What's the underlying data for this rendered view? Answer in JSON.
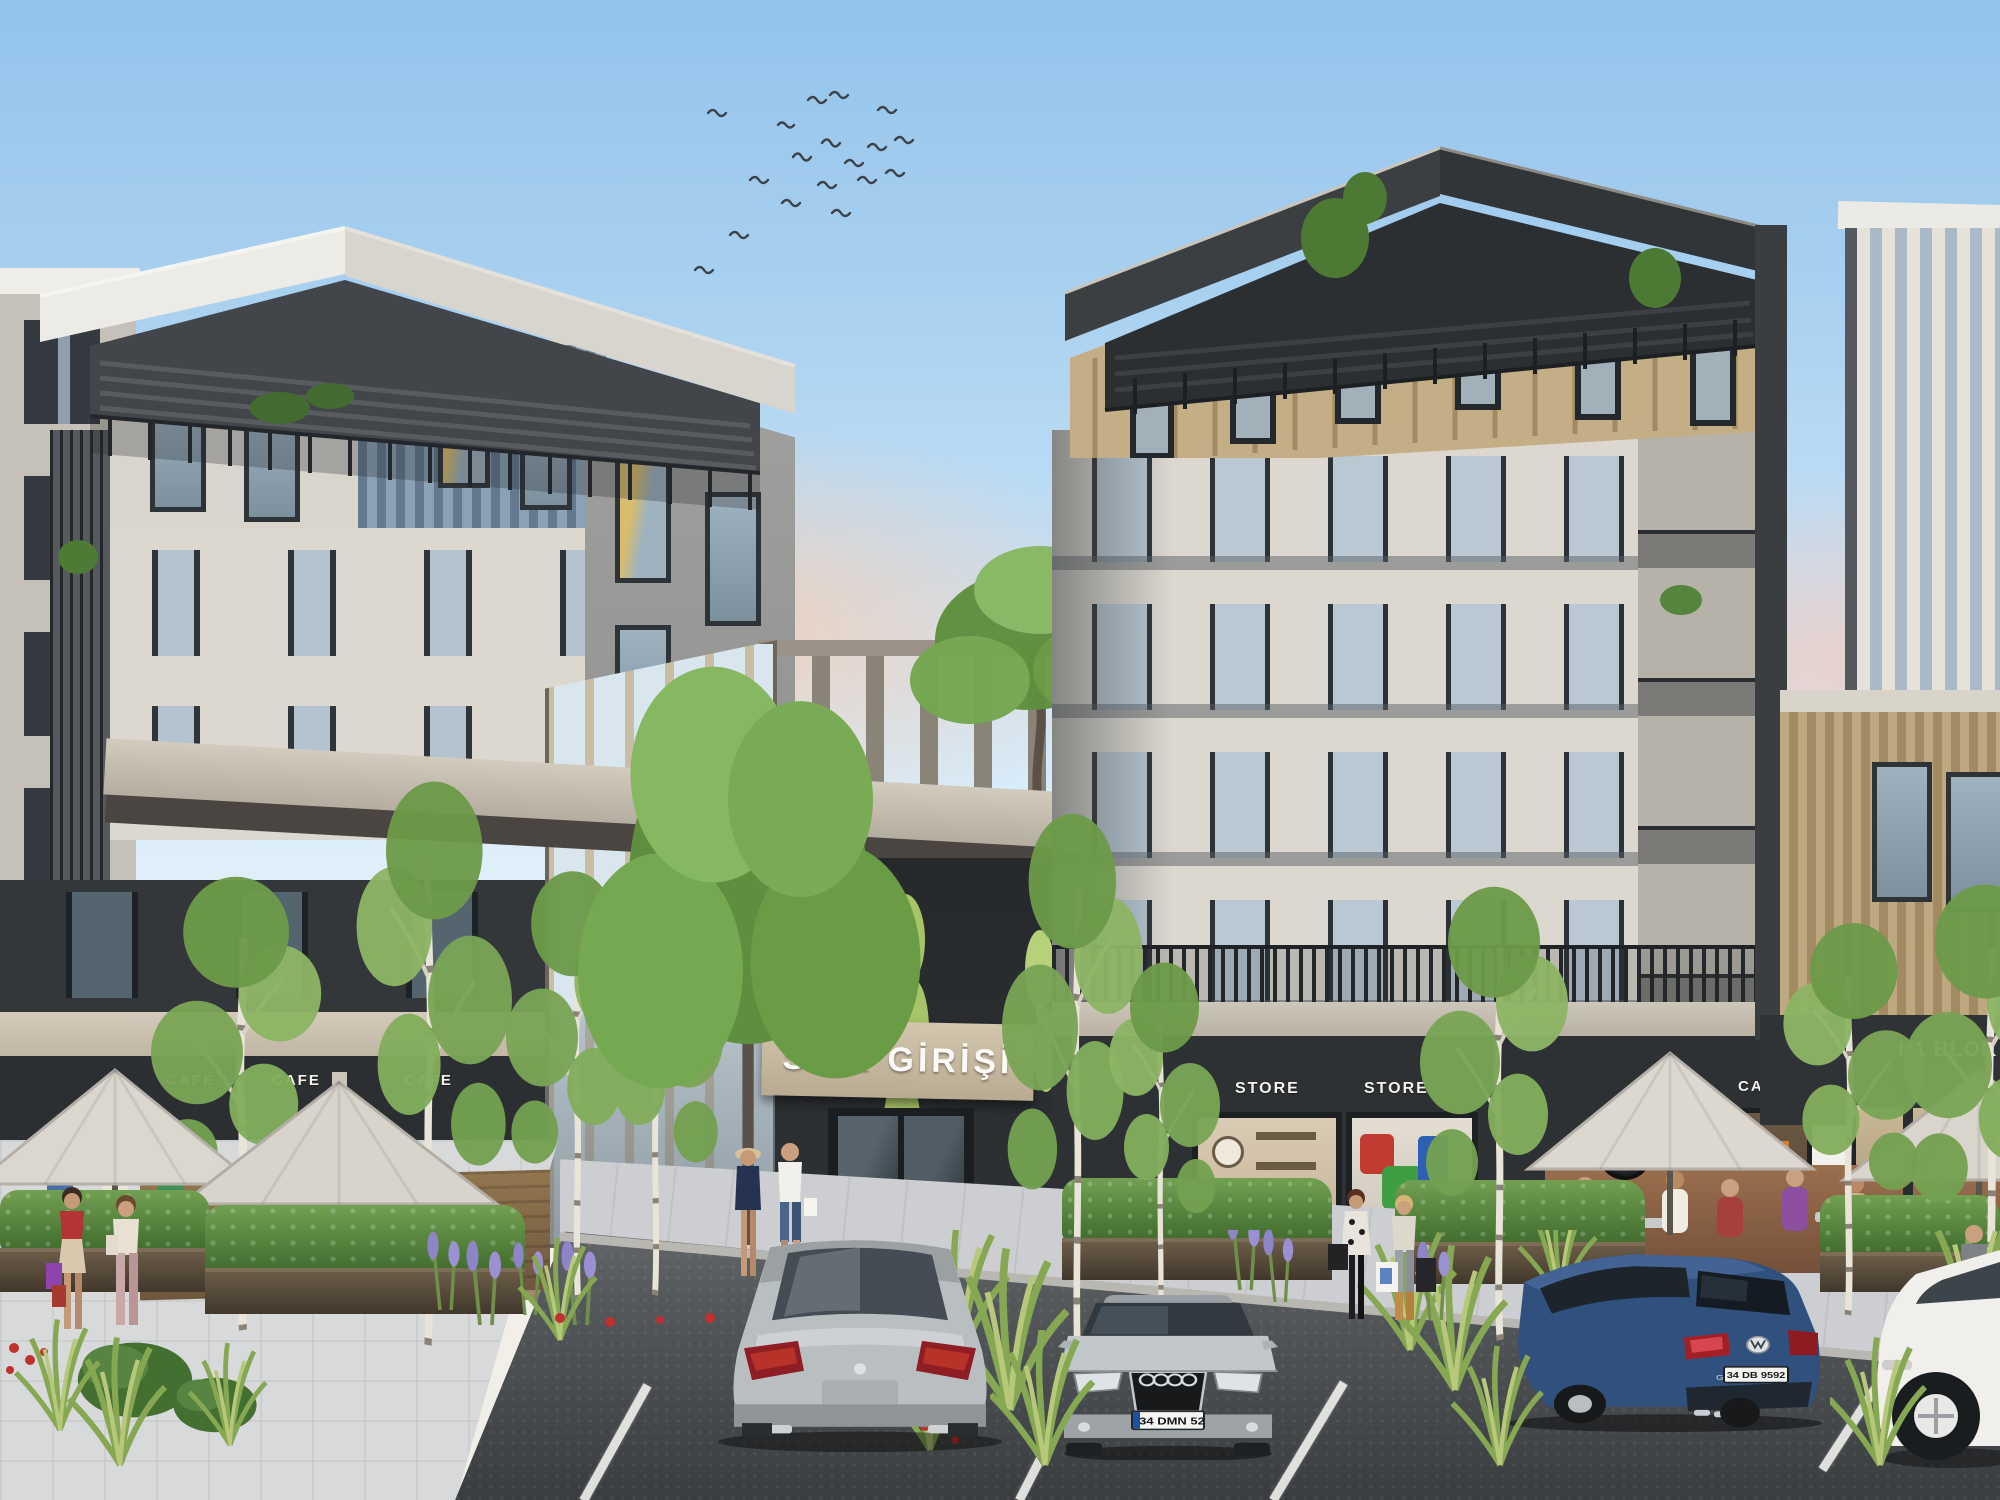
{
  "scene": {
    "description": "Daytime architectural rendering of a modern residential complex: two five-storey blocks with white facades, charcoal bases, wood and blue-grey slat accents, a central SITE GIRISI entrance, ground-floor cafes and stores with outdoor umbrella seating, landscaped plaza with birch trees, pedestrians with shopping bags, and a foreground parking lot with cars; a flock of birds in the blue sky"
  },
  "signs": {
    "entrance": "SİTE GİRİŞİ",
    "left_cafes": [
      "CAFE",
      "CAFE",
      "CAFE"
    ],
    "stores": [
      "STORE",
      "STORE"
    ],
    "right_cafes": [
      "CAFE",
      "CAFE"
    ],
    "block": "H1 BLOK"
  },
  "vehicles": {
    "audi": {
      "plate": "34 DMN 52"
    },
    "golf": {
      "plate": "34 DB 9592",
      "badge": "GOLF"
    }
  },
  "palette": {
    "sky_top": "#93c3eb",
    "horizon_glow": "#f6cdb2",
    "facade_light": "#dcd8d0",
    "facade_charcoal": "#2e3134",
    "wood_slat": "#b49c72",
    "blue_siding": "#7b90a4",
    "sign_band": "#c8b89e",
    "umbrella": "#dbd7cf",
    "hedge_green": "#4f7d3a",
    "asphalt": "#4b4e51",
    "paving": "#d6d7d9"
  }
}
